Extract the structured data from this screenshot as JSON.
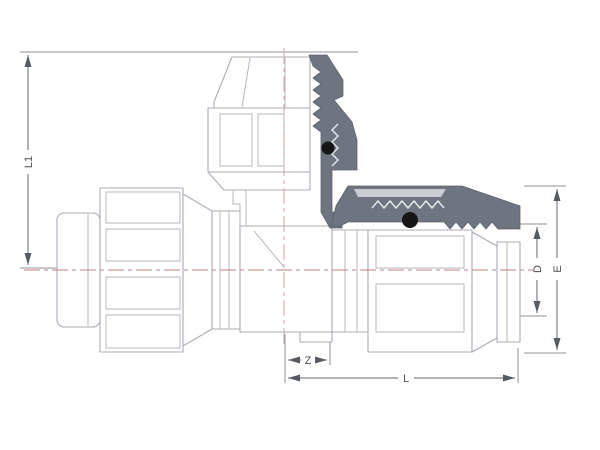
{
  "drawing": {
    "kind": "Technical dimension drawing",
    "subject": "Compression tee pipe fitting, half-section view with O-rings",
    "labels": {
      "l1": "L1",
      "d": "D",
      "e": "E",
      "z": "Z",
      "l": "L"
    },
    "colors": {
      "background": "#ffffff",
      "outline_gray": "#a9aeb6",
      "section_gray": "#6e7580",
      "section_highlight": "#c9ccd2",
      "o_ring_black": "#161616",
      "centerline_red": "#bd8282",
      "dimension_gray": "#60656d"
    }
  }
}
